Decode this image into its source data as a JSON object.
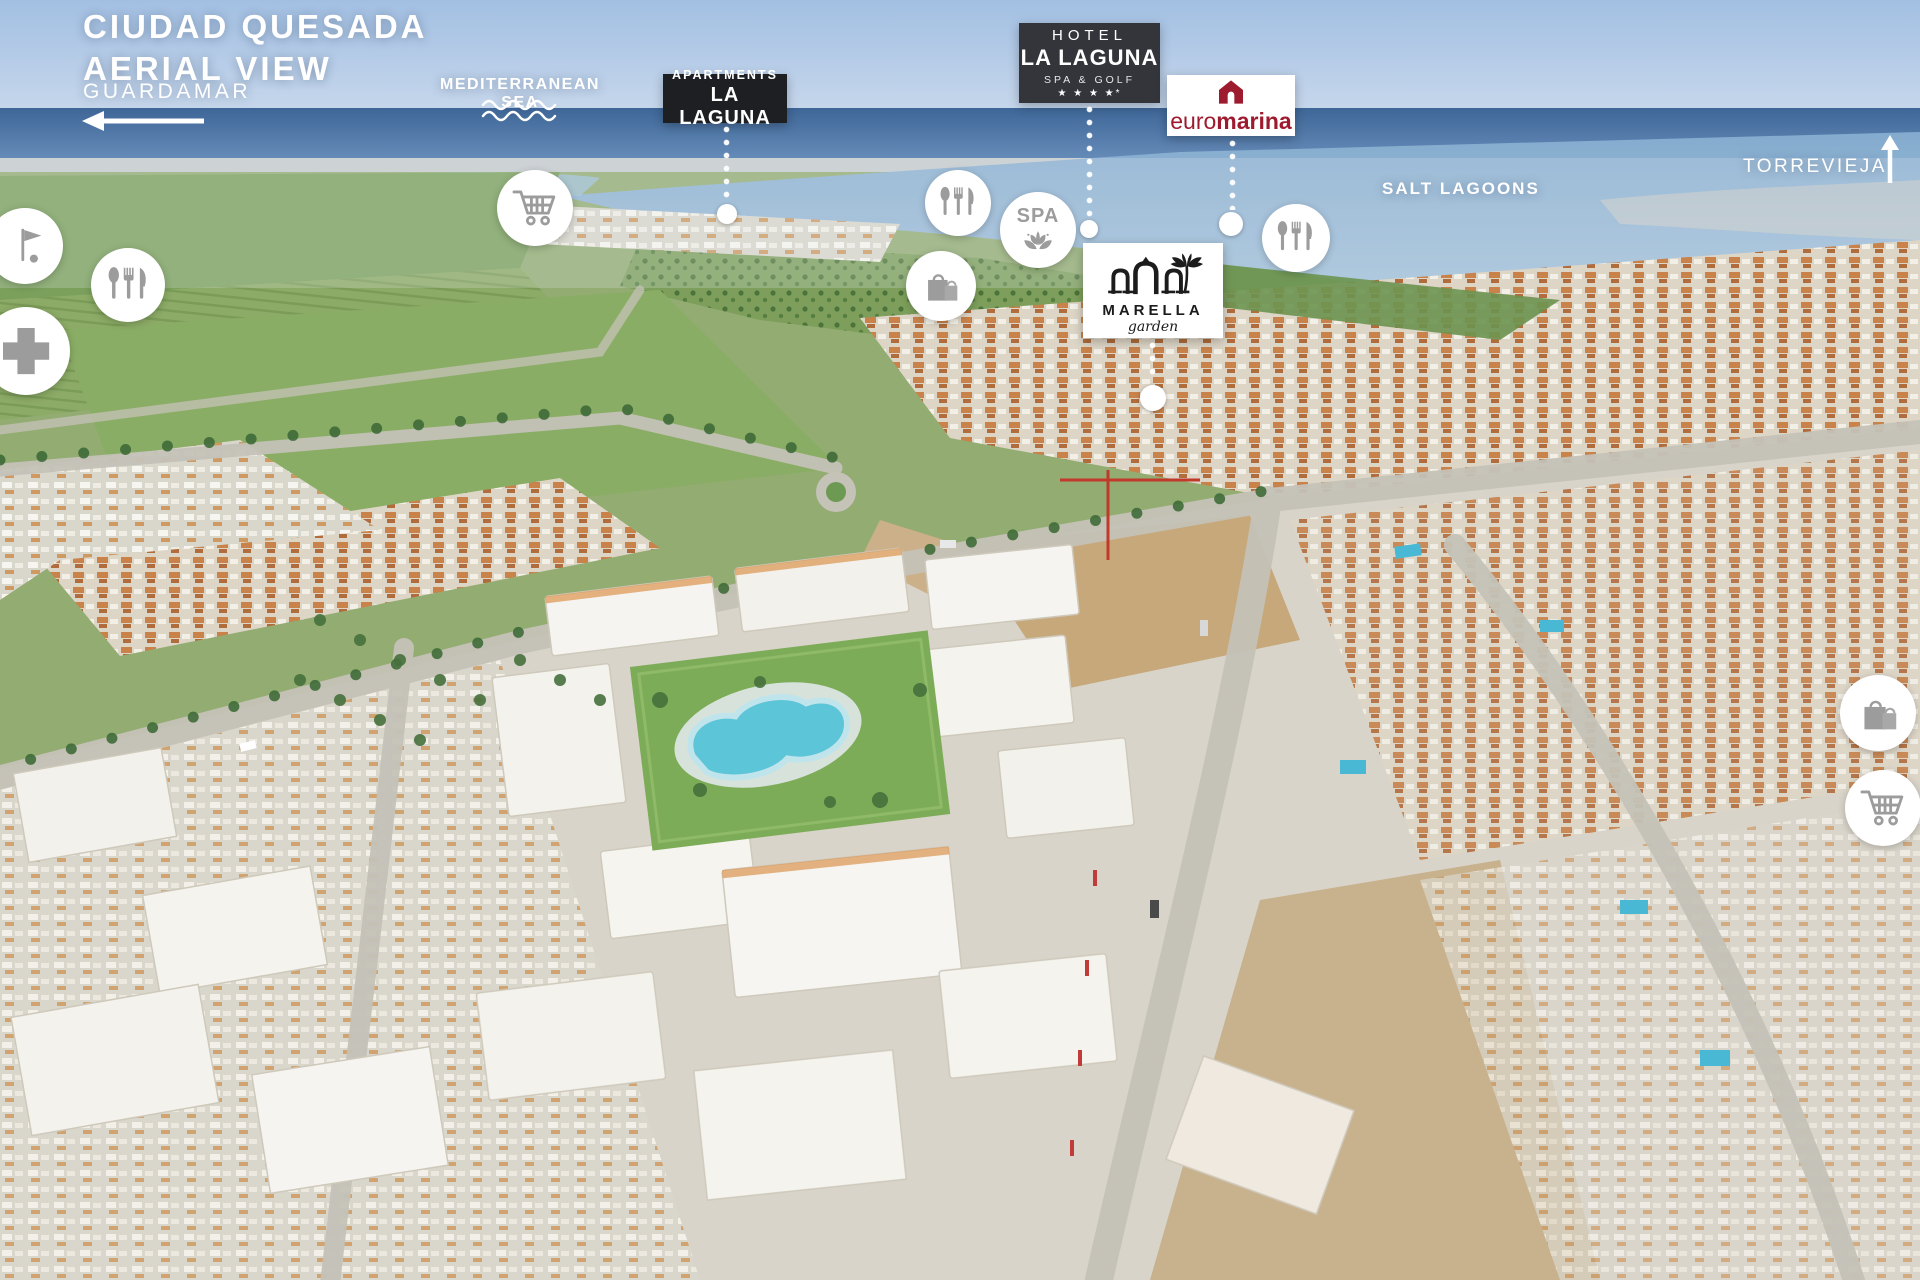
{
  "header": {
    "title_line1": "CIUDAD QUESADA",
    "title_line2": "AERIAL VIEW"
  },
  "directions": {
    "guardamar": "GUARDAMAR",
    "torrevieja": "TORREVIEJA"
  },
  "labels": {
    "sea": "MEDITERRANEAN SEA",
    "salt_lagoons": "SALT LAGOONS"
  },
  "badges": {
    "apartments": {
      "top": "APARTMENTS",
      "name": "LA LAGUNA"
    },
    "hotel": {
      "top": "HOTEL",
      "name": "LA LAGUNA",
      "subtitle": "SPA & GOLF",
      "stars": "★ ★ ★ ★*"
    },
    "euromarina": {
      "part1": "euro",
      "part2": "marina"
    },
    "marella": {
      "name": "MARELLA",
      "subtitle": "garden"
    }
  },
  "poi": {
    "spa_label": "SPA",
    "icons": [
      "golf-icon",
      "restaurant-icon",
      "medical-cross-icon",
      "shopping-cart-icon",
      "restaurant-icon",
      "spa-lotus-icon",
      "shopping-bags-icon",
      "restaurant-icon",
      "shopping-bags-icon",
      "shopping-cart-icon"
    ]
  },
  "colors": {
    "badge_dark": "#33353b",
    "badge_darker": "#1e1f22",
    "euromarina_red": "#9e1b2f",
    "marella_ink": "#1b1b1b",
    "poi_glyph": "#9c9c9c",
    "overlay_text": "#ffffff"
  }
}
